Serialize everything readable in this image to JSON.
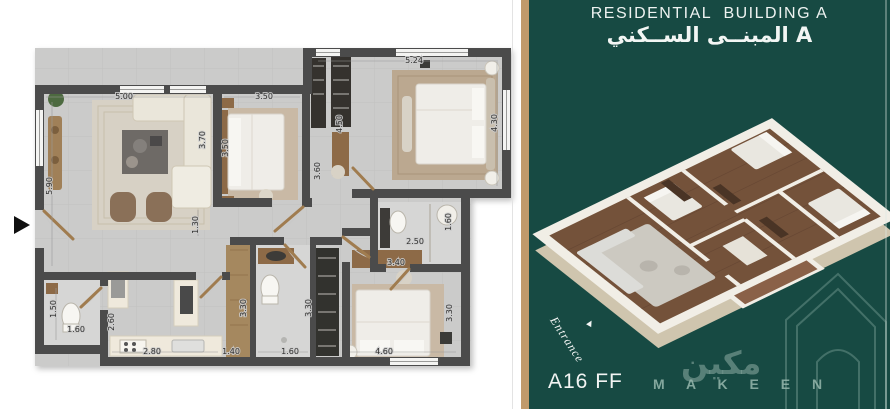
{
  "left_panel": {
    "floor_plan": {
      "dimensions": [
        {
          "label": "5.00",
          "x": 124,
          "y": 99,
          "v": false
        },
        {
          "label": "5.90",
          "x": 52,
          "y": 186,
          "v": true
        },
        {
          "label": "3.70",
          "x": 205,
          "y": 140,
          "v": true
        },
        {
          "label": "3.50",
          "x": 264,
          "y": 99,
          "v": false
        },
        {
          "label": "3.50",
          "x": 228,
          "y": 148,
          "v": true
        },
        {
          "label": "3.60",
          "x": 320,
          "y": 171,
          "v": true
        },
        {
          "label": "4.50",
          "x": 342,
          "y": 124,
          "v": true
        },
        {
          "label": "5.24",
          "x": 414,
          "y": 63,
          "v": false
        },
        {
          "label": "4.30",
          "x": 497,
          "y": 123,
          "v": true
        },
        {
          "label": "1.30",
          "x": 198,
          "y": 225,
          "v": true
        },
        {
          "label": "1.50",
          "x": 56,
          "y": 309,
          "v": true
        },
        {
          "label": "1.60",
          "x": 76,
          "y": 332,
          "v": false
        },
        {
          "label": "2.60",
          "x": 114,
          "y": 322,
          "v": true
        },
        {
          "label": "2.80",
          "x": 152,
          "y": 354,
          "v": false
        },
        {
          "label": "1.40",
          "x": 231,
          "y": 354,
          "v": false
        },
        {
          "label": "1.60",
          "x": 290,
          "y": 354,
          "v": false
        },
        {
          "label": "3.30",
          "x": 246,
          "y": 308,
          "v": true
        },
        {
          "label": "3.30",
          "x": 311,
          "y": 308,
          "v": true
        },
        {
          "label": "3.40",
          "x": 396,
          "y": 265,
          "v": false
        },
        {
          "label": "2.50",
          "x": 415,
          "y": 244,
          "v": false
        },
        {
          "label": "1.60",
          "x": 451,
          "y": 222,
          "v": true
        },
        {
          "label": "3.30",
          "x": 452,
          "y": 313,
          "v": true
        },
        {
          "label": "4.60",
          "x": 384,
          "y": 354,
          "v": false
        }
      ]
    }
  },
  "right_panel": {
    "title_en": "RESIDENTIAL  BUILDING A",
    "title_ar": "المبنــى الســكني A",
    "unit_code": "A16 FF",
    "entrance_label": "Entrance",
    "brand_name": "M A K E E N",
    "brand_name_ar": "مكين"
  },
  "colors": {
    "panel_green": "#174a43",
    "gold_stripe": "#c09a6b",
    "wall_grey": "#4c4c4b",
    "wood_brown": "#8d6a46",
    "watermark_green": "#8cafa5"
  }
}
